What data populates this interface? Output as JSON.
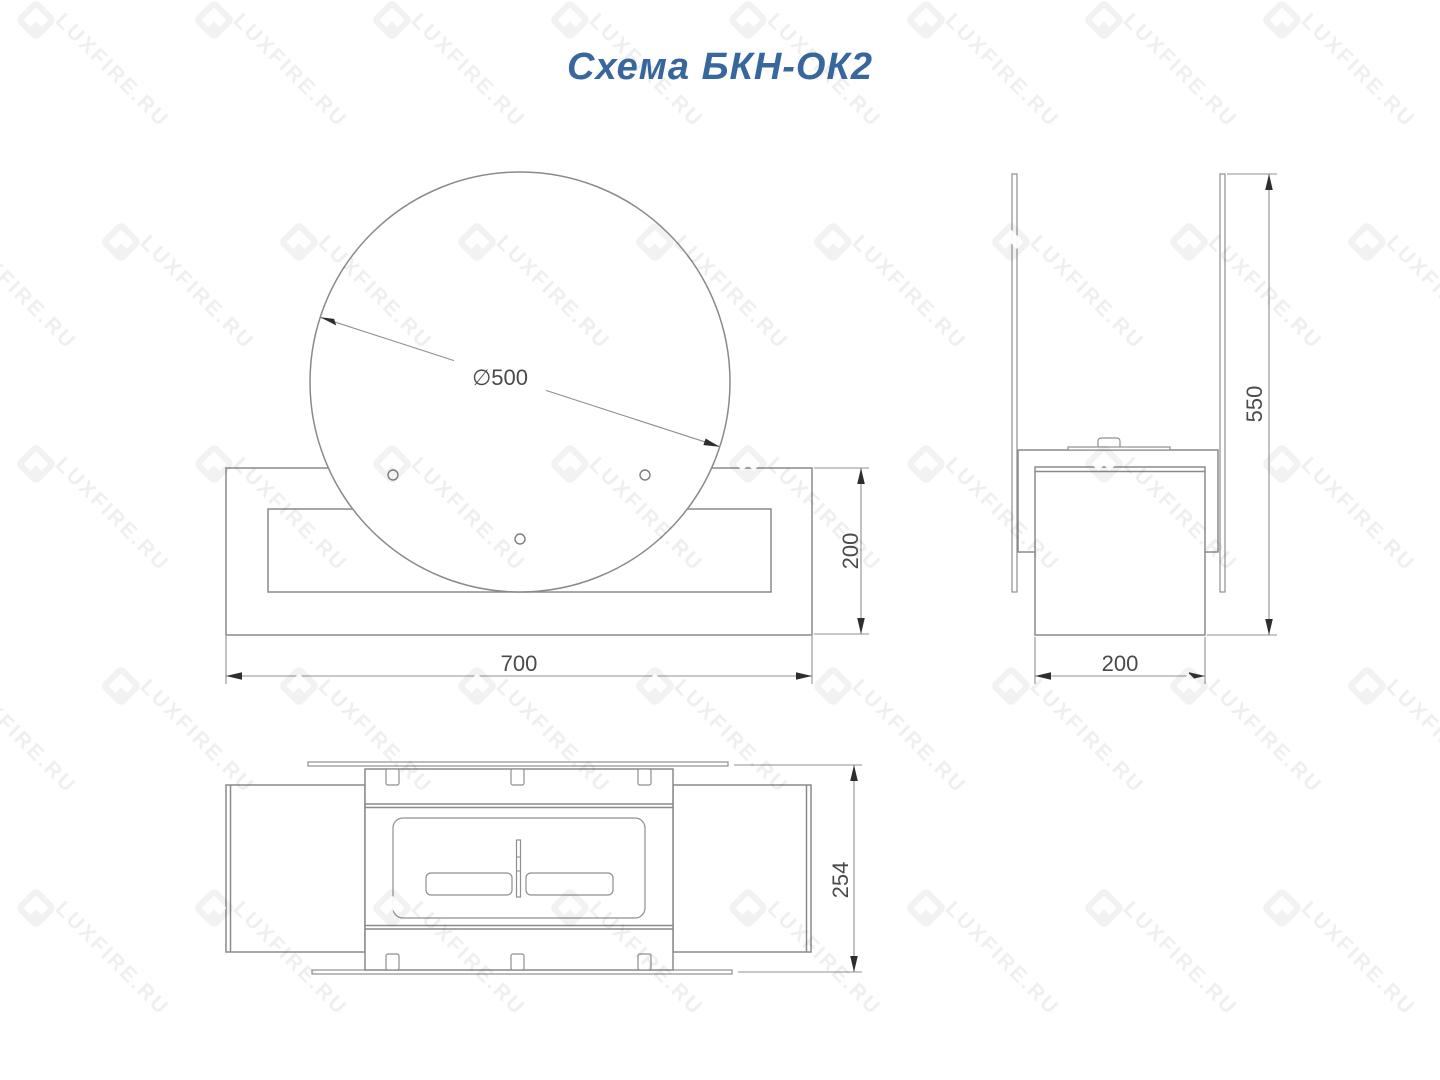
{
  "title": "Схема БКН-ОК2",
  "watermark": {
    "text": "LUXFIRE.RU"
  },
  "colors": {
    "accent_blue": "#38679e",
    "line_gray": "#8a8a8a",
    "dim_text": "#4a4a4a"
  },
  "dims": {
    "diameter": "∅500",
    "front_width": "700",
    "front_height": "200",
    "side_height": "550",
    "side_depth": "200",
    "top_depth": "254"
  }
}
